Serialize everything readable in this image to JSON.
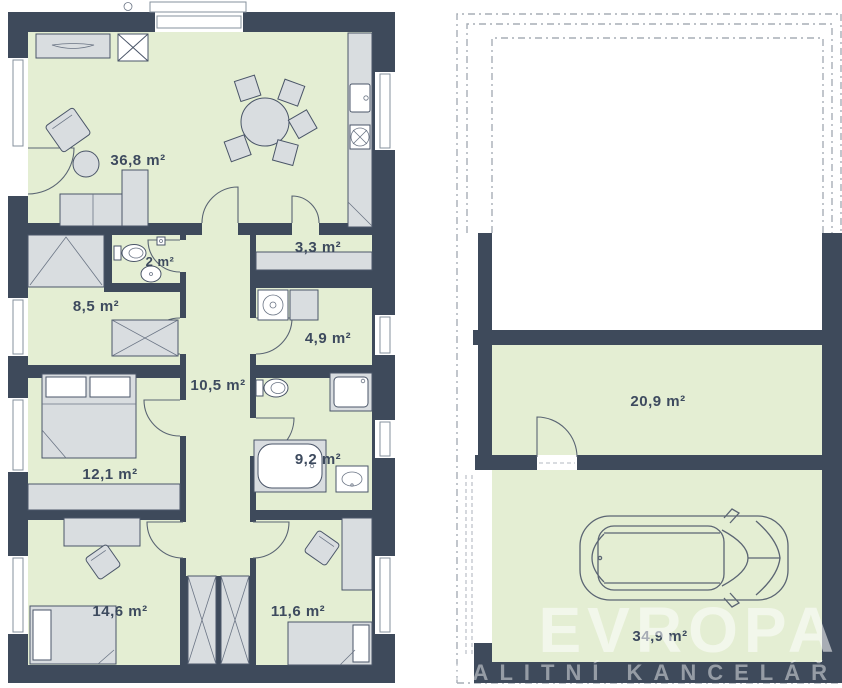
{
  "labels": {
    "living": "36,8 m²",
    "wc": "2 m²",
    "entry": "3,3 m²",
    "closet": "8,5 m²",
    "tech": "4,9 m²",
    "hall": "10,5 m²",
    "bedroom1": "12,1 m²",
    "bathroom": "9,2 m²",
    "bedroom2": "14,6 m²",
    "bedroom3": "11,6 m²",
    "storage": "20,9 m²",
    "garage": "34,9 m²"
  },
  "watermark": {
    "line1": "EVROPA",
    "line2": "REALITNÍ KANCELÁŘ"
  },
  "palette": {
    "wall": "#3e4a5b",
    "floor": "#e4eed3",
    "furniture": "#d9dde0",
    "outline": "#4a5568",
    "watermark_text": "#ffffff"
  }
}
